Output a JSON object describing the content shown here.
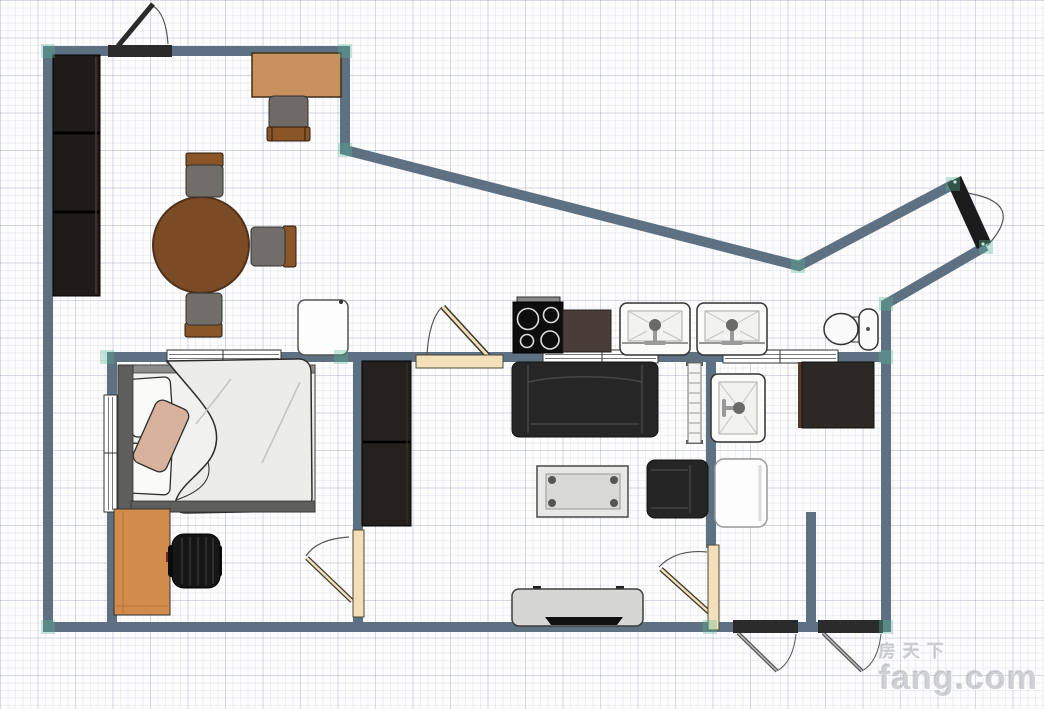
{
  "watermark": {
    "brand_cn": "房天下",
    "brand_en": "fang.com"
  },
  "canvas": {
    "width": 1044,
    "height": 709,
    "grid_minor_px": 7.5,
    "grid_major_px": 37.5
  },
  "colors": {
    "wall": "#5d7183",
    "corner_highlight": "#59b894",
    "door_wood": "#f3e0bb",
    "door_lintel_dark": "#2b2b2b",
    "entry_door_dark": "#1c1c1c",
    "cabinet_dark": "#221f1c",
    "dining_table_wood": "#7a4b24",
    "desk_wood": "#c9915d",
    "bedroom_desk_wood": "#d18b4a",
    "chair_seat_gray": "#716d68",
    "chair_back_wood": "#8a5628",
    "sofa_dark": "#262626",
    "counter_brown": "#493c39",
    "stove_black": "#0d0d0d",
    "fixture_white": "#fbfbfa",
    "tv_stand_gray": "#d6d6d4",
    "bed_linen": "#ededeb",
    "pillow_tan": "#d8b29c"
  },
  "furniture": [
    {
      "id": "tall-wardrobe",
      "label": "tall wardrobe (3 sections)"
    },
    {
      "id": "desk",
      "label": "desk"
    },
    {
      "id": "desk-chair",
      "label": "desk chair"
    },
    {
      "id": "dining-table",
      "label": "round dining table"
    },
    {
      "id": "dining-chair-north",
      "label": "dining chair"
    },
    {
      "id": "dining-chair-east",
      "label": "dining chair"
    },
    {
      "id": "dining-chair-south",
      "label": "dining chair"
    },
    {
      "id": "mini-fridge",
      "label": "small white cabinet"
    },
    {
      "id": "stove",
      "label": "4-burner cooktop"
    },
    {
      "id": "kitchen-counter",
      "label": "counter"
    },
    {
      "id": "kitchen-sink-1",
      "label": "washbasin"
    },
    {
      "id": "kitchen-sink-2",
      "label": "washbasin"
    },
    {
      "id": "toilet",
      "label": "toilet"
    },
    {
      "id": "hall-wardrobe",
      "label": "wardrobe"
    },
    {
      "id": "sofa",
      "label": "sofa"
    },
    {
      "id": "radiator",
      "label": "radiator"
    },
    {
      "id": "coffee-table",
      "label": "coffee table"
    },
    {
      "id": "armchair",
      "label": "armchair"
    },
    {
      "id": "tv-stand",
      "label": "TV stand with TV"
    },
    {
      "id": "bathroom-basin",
      "label": "washbasin"
    },
    {
      "id": "bathroom-cabinet",
      "label": "dark cabinet"
    },
    {
      "id": "shower-tray",
      "label": "shower tray"
    },
    {
      "id": "bed",
      "label": "double bed"
    },
    {
      "id": "bedroom-desk",
      "label": "desk"
    },
    {
      "id": "office-chair",
      "label": "office chair"
    }
  ],
  "openings": [
    {
      "id": "entry-door-top",
      "label": "hinged door"
    },
    {
      "id": "main-entrance-door",
      "label": "entrance door on diagonal wall"
    },
    {
      "id": "kitchen-door",
      "label": "hinged door"
    },
    {
      "id": "bedroom-door",
      "label": "hinged door"
    },
    {
      "id": "living-door",
      "label": "hinged door"
    },
    {
      "id": "balcony-door-1",
      "label": "hinged door"
    },
    {
      "id": "balcony-door-2",
      "label": "hinged door"
    },
    {
      "id": "window-bedroom-top",
      "label": "window"
    },
    {
      "id": "window-bedroom-left",
      "label": "window"
    },
    {
      "id": "window-kitchen-1",
      "label": "window"
    },
    {
      "id": "window-kitchen-2",
      "label": "window"
    }
  ]
}
